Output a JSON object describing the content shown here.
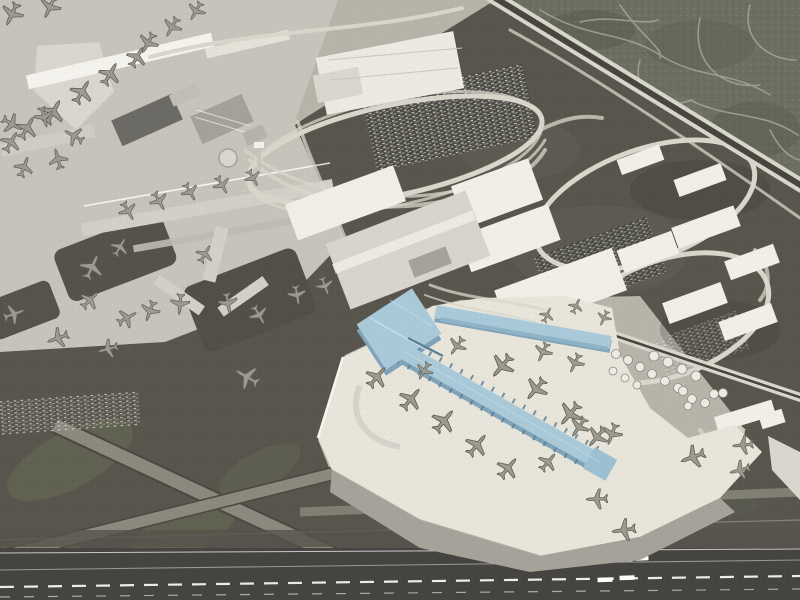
{
  "scene": {
    "title": "Airport expansion aerial rendering",
    "description": "Oblique aerial 3D rendering of a large airport. A proposed new T-shaped concourse is highlighted in light blue on a bright new apron surrounded by parked jets. Existing gray terminals, piers and parked aircraft fill the upper left; a white parking garage with looping access ramps sits top center; a freeway separates a residential neighborhood in the top right; an industrial zone with white warehouses, car lots and a fuel tank farm lies to the right; dark runways and taxiways with white markings cross the bottom.",
    "highlight_label": "proposed-new-concourse",
    "plane_count": 57,
    "tank_count": 19
  },
  "palette": {
    "base": "#b6b3a9",
    "apron_light": "#c6c3ba",
    "apron_slab": "#d9d6cd",
    "apron_bright": "#e7e4da",
    "apron_mid": "#a5a399",
    "tarmac_dark": "#57554c",
    "tarmac_deep": "#4a4841",
    "runway": "#454440",
    "residential": "#6b6e60",
    "street": "#a2a194",
    "road": "#d8d5ca",
    "road_dark": "#44433c",
    "taxi": "#8b897d",
    "building_white": "#f0eee7",
    "building_beige": "#d7d4cb",
    "building_gray": "#a3a19a",
    "roof_dark": "#6c6a64",
    "blue_top": "#a9c9d9",
    "blue_mid": "#8fb3c6",
    "blue_edge": "#7fa3b8",
    "blue_dark": "#5d7f94",
    "plane": "#9d9b90",
    "plane_dark": "#5f5d55",
    "grass": "#6d7058",
    "white": "#ffffff"
  },
  "planes": [
    [
      12,
      14,
      205,
      1.15
    ],
    [
      50,
      7,
      205,
      1.1
    ],
    [
      148,
      43,
      210,
      1.05
    ],
    [
      172,
      27,
      210,
      1.0
    ],
    [
      196,
      11,
      210,
      0.95
    ],
    [
      137,
      57,
      30,
      1.05
    ],
    [
      110,
      74,
      30,
      1.15
    ],
    [
      82,
      92,
      30,
      1.2
    ],
    [
      53,
      112,
      30,
      1.25
    ],
    [
      27,
      128,
      30,
      1.15
    ],
    [
      11,
      142,
      30,
      1.05
    ],
    [
      12,
      124,
      120,
      1.05
    ],
    [
      44,
      117,
      165,
      1.0
    ],
    [
      74,
      136,
      300,
      1.0
    ],
    [
      24,
      167,
      20,
      1.0
    ],
    [
      58,
      159,
      345,
      1.0
    ],
    [
      128,
      211,
      150,
      0.95
    ],
    [
      159,
      201,
      150,
      0.95
    ],
    [
      190,
      192,
      150,
      0.9
    ],
    [
      222,
      185,
      150,
      0.9
    ],
    [
      253,
      178,
      150,
      0.85
    ],
    [
      92,
      267,
      25,
      1.25
    ],
    [
      120,
      247,
      30,
      0.95
    ],
    [
      205,
      254,
      30,
      0.9
    ],
    [
      150,
      311,
      200,
      1.0
    ],
    [
      180,
      304,
      185,
      1.0
    ],
    [
      228,
      303,
      170,
      1.0
    ],
    [
      259,
      315,
      150,
      1.0
    ],
    [
      297,
      295,
      170,
      0.95
    ],
    [
      325,
      286,
      160,
      0.9
    ],
    [
      90,
      300,
      45,
      1.0
    ],
    [
      127,
      318,
      60,
      1.0
    ],
    [
      14,
      314,
      70,
      1.05
    ],
    [
      58,
      338,
      250,
      1.05
    ],
    [
      108,
      349,
      255,
      1.0
    ],
    [
      247,
      377,
      300,
      1.25
    ],
    [
      377,
      377,
      40,
      1.15
    ],
    [
      411,
      399,
      40,
      1.2
    ],
    [
      444,
      421,
      40,
      1.25
    ],
    [
      477,
      445,
      40,
      1.2
    ],
    [
      508,
      468,
      40,
      1.15
    ],
    [
      502,
      366,
      220,
      1.25
    ],
    [
      536,
      389,
      220,
      1.2
    ],
    [
      570,
      414,
      220,
      1.25
    ],
    [
      597,
      437,
      220,
      1.1
    ],
    [
      424,
      371,
      210,
      0.9
    ],
    [
      457,
      346,
      215,
      0.95
    ],
    [
      543,
      352,
      205,
      0.95
    ],
    [
      575,
      363,
      205,
      0.95
    ],
    [
      547,
      315,
      25,
      0.75
    ],
    [
      576,
      306,
      25,
      0.75
    ],
    [
      604,
      318,
      205,
      0.75
    ],
    [
      579,
      427,
      215,
      1.05
    ],
    [
      612,
      434,
      200,
      1.05
    ],
    [
      548,
      462,
      40,
      1.0
    ],
    [
      693,
      457,
      250,
      1.2
    ],
    [
      743,
      445,
      265,
      1.0
    ],
    [
      740,
      470,
      255,
      1.0
    ],
    [
      597,
      499,
      268,
      1.05
    ],
    [
      624,
      530,
      262,
      1.15
    ]
  ],
  "tanks": [
    [
      616,
      354,
      4.5
    ],
    [
      628,
      360,
      4.5
    ],
    [
      640,
      367,
      4.5
    ],
    [
      652,
      374,
      4.5
    ],
    [
      665,
      381,
      4.5
    ],
    [
      678,
      388,
      4.5
    ],
    [
      613,
      371,
      4
    ],
    [
      625,
      378,
      4
    ],
    [
      637,
      385,
      4
    ],
    [
      654,
      356,
      5
    ],
    [
      668,
      362,
      5
    ],
    [
      682,
      369,
      5
    ],
    [
      696,
      376,
      5
    ],
    [
      683,
      391,
      4.5
    ],
    [
      692,
      399,
      4.5
    ],
    [
      705,
      403,
      4.5
    ],
    [
      714,
      394,
      4.5
    ],
    [
      723,
      393,
      4.5
    ],
    [
      688,
      406,
      4
    ]
  ]
}
